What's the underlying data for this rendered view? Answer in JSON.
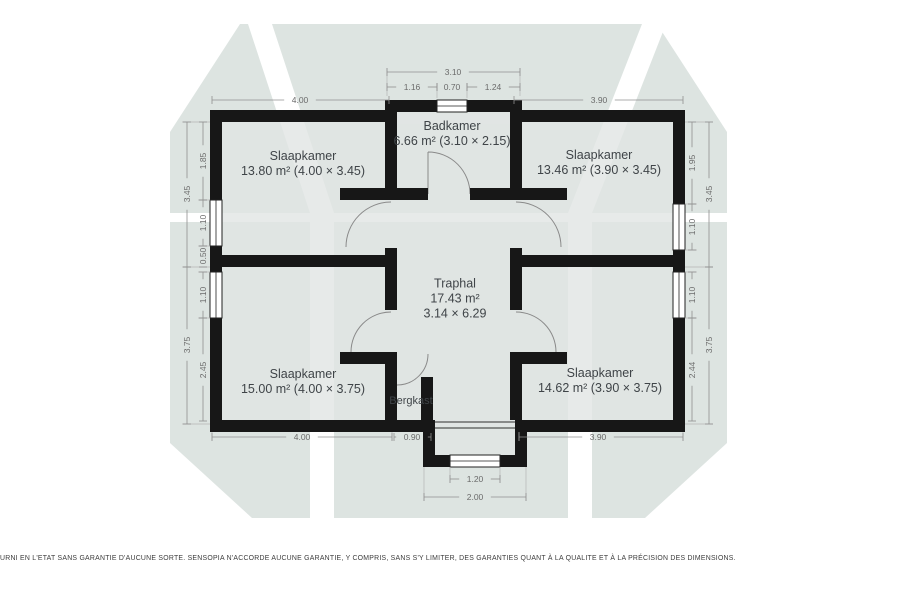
{
  "page": {
    "background": "#ffffff"
  },
  "watermark": {
    "color": "#dde4e1",
    "stripe_color": "#ffffff"
  },
  "plan": {
    "wall_color": "#171717",
    "floor_color": "rgba(225,229,227,0.8)",
    "dim_line_color": "#909090",
    "dim_text_color": "#6b6b6b",
    "room_text_color": "#3f4448",
    "rooms": {
      "badkamer": {
        "name": "Badkamer",
        "line2": "6.66 m² (3.10 × 2.15)"
      },
      "slaapkamer_tl": {
        "name": "Slaapkamer",
        "line2": "13.80 m² (4.00 × 3.45)"
      },
      "slaapkamer_tr": {
        "name": "Slaapkamer",
        "line2": "13.46 m² (3.90 × 3.45)"
      },
      "traphal": {
        "name": "Traphal",
        "line2": "17.43 m²",
        "line3": "3.14 × 6.29"
      },
      "slaapkamer_bl": {
        "name": "Slaapkamer",
        "line2": "15.00 m² (4.00 × 3.75)"
      },
      "slaapkamer_br": {
        "name": "Slaapkamer",
        "line2": "14.62 m² (3.90 × 3.75)"
      },
      "bergkast": {
        "name": "Bergkast"
      }
    },
    "dimensions": [
      {
        "v": "3.10",
        "o": "h",
        "x": 453,
        "y": 72,
        "from": 387,
        "to": 520
      },
      {
        "v": "1.16",
        "o": "h",
        "x": 412,
        "y": 87,
        "from": 387,
        "to": 437
      },
      {
        "v": "0.70",
        "o": "h",
        "x": 452,
        "y": 87,
        "from": 437,
        "to": 467
      },
      {
        "v": "1.24",
        "o": "h",
        "x": 493,
        "y": 87,
        "from": 467,
        "to": 520
      },
      {
        "v": "4.00",
        "o": "h",
        "x": 300,
        "y": 100,
        "from": 212,
        "to": 389
      },
      {
        "v": "3.90",
        "o": "h",
        "x": 599,
        "y": 100,
        "from": 514,
        "to": 683
      },
      {
        "v": "4.00",
        "o": "h",
        "x": 302,
        "y": 437,
        "from": 212,
        "to": 392
      },
      {
        "v": "0.90",
        "o": "h",
        "x": 412,
        "y": 437,
        "from": 394,
        "to": 431
      },
      {
        "v": "3.90",
        "o": "h",
        "x": 598,
        "y": 437,
        "from": 519,
        "to": 683
      },
      {
        "v": "1.20",
        "o": "h",
        "x": 475,
        "y": 479,
        "from": 450,
        "to": 500
      },
      {
        "v": "2.00",
        "o": "h",
        "x": 475,
        "y": 497,
        "from": 424,
        "to": 526
      },
      {
        "v": "3.45",
        "o": "v",
        "x": 187,
        "y": 194,
        "from": 122,
        "to": 267
      },
      {
        "v": "3.75",
        "o": "v",
        "x": 187,
        "y": 345,
        "from": 267,
        "to": 424
      },
      {
        "v": "1.85",
        "o": "v",
        "x": 203,
        "y": 161,
        "from": 122,
        "to": 200
      },
      {
        "v": "1.10",
        "o": "v",
        "x": 203,
        "y": 223,
        "from": 200,
        "to": 246
      },
      {
        "v": "0.50",
        "o": "v",
        "x": 203,
        "y": 256,
        "from": 246,
        "to": 267
      },
      {
        "v": "1.10",
        "o": "v",
        "x": 203,
        "y": 295,
        "from": 272,
        "to": 318
      },
      {
        "v": "2.45",
        "o": "v",
        "x": 203,
        "y": 370,
        "from": 318,
        "to": 421
      },
      {
        "v": "1.95",
        "o": "v",
        "x": 692,
        "y": 163,
        "from": 122,
        "to": 204
      },
      {
        "v": "1.10",
        "o": "v",
        "x": 692,
        "y": 227,
        "from": 204,
        "to": 250
      },
      {
        "v": "1.10",
        "o": "v",
        "x": 692,
        "y": 295,
        "from": 272,
        "to": 318
      },
      {
        "v": "2.44",
        "o": "v",
        "x": 692,
        "y": 370,
        "from": 318,
        "to": 421
      },
      {
        "v": "3.45",
        "o": "v",
        "x": 709,
        "y": 194,
        "from": 122,
        "to": 267
      },
      {
        "v": "3.75",
        "o": "v",
        "x": 709,
        "y": 345,
        "from": 267,
        "to": 424
      }
    ]
  },
  "footer": {
    "disclaimer": "URNI EN L'ETAT SANS GARANTIE D'AUCUNE SORTE. SENSOPIA N'ACCORDE AUCUNE GARANTIE, Y COMPRIS, SANS S'Y LIMITER, DES GARANTIES QUANT À LA QUALITE ET À LA PRÉCISION DES DIMENSIONS."
  }
}
